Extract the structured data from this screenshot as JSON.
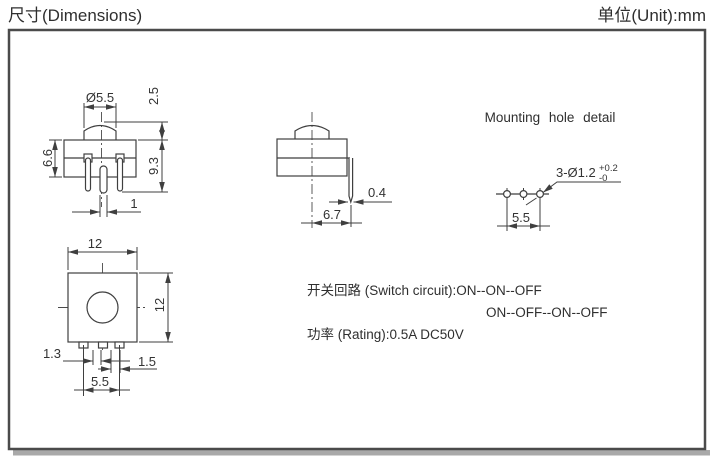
{
  "header": {
    "title_left": "尺寸(Dimensions)",
    "title_right": "单位(Unit):mm"
  },
  "front_view": {
    "button_diameter": "Ø5.5",
    "button_height": "2.5",
    "body_height": "6.6",
    "total_height": "9.3",
    "pin_width": "1"
  },
  "side_view": {
    "pin_thickness": "0.4",
    "pin_offset": "6.7"
  },
  "mounting_detail": {
    "title": "Mounting hole detail",
    "hole_spec": "3-Ø1.2",
    "tolerance_plus": "+0.2",
    "tolerance_minus": "-0",
    "hole_pitch": "5.5"
  },
  "top_view": {
    "width": "12",
    "height": "12",
    "pin_dim_left": "1.3",
    "pin_dim_right": "1.5",
    "pin_pitch": "5.5"
  },
  "specs": {
    "switch_circuit": "开关回路  (Switch circuit):ON--ON--OFF",
    "switch_circuit_line2": "ON--OFF--ON--OFF",
    "rating": "功率 (Rating):0.5A DC50V"
  },
  "colors": {
    "line": "#3f3f3f",
    "text": "#2f2f2f",
    "border": "#4b4b4b",
    "shadow": "#a9a9a9",
    "background": "#ffffff"
  }
}
